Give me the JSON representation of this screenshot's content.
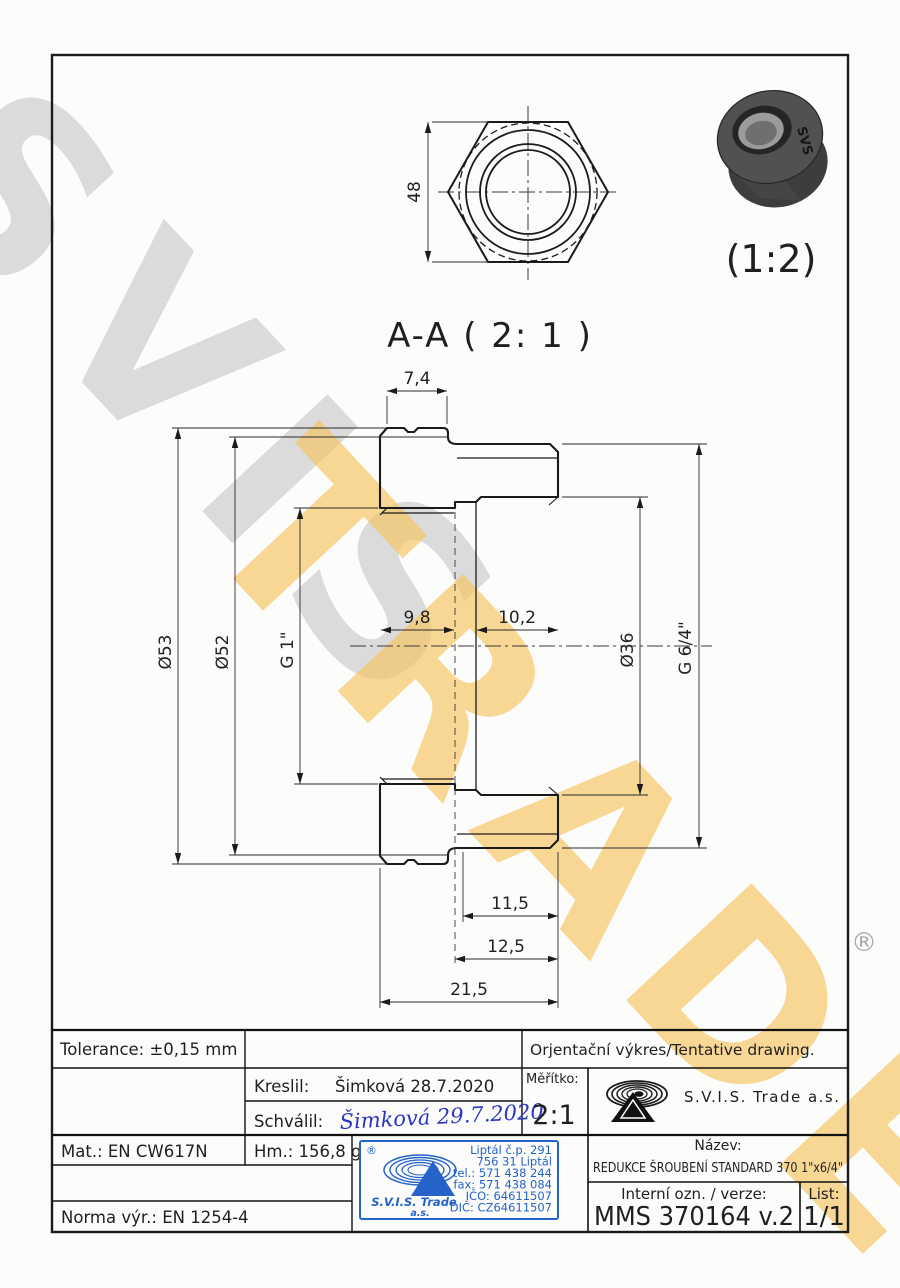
{
  "watermark": {
    "word1": "SVIS",
    "word2": "TRADE",
    "registered": "®"
  },
  "drawing": {
    "top_view_dim": "48",
    "photo_scale": "(1:2)",
    "photo_brand": "SVS",
    "section_title": "A-A ( 2: 1 )",
    "dims": {
      "flange_width": "7,4",
      "od": "Ø53",
      "af": "Ø52",
      "thread_left": "G 1\"",
      "depth_left": "9,8",
      "depth_right": "10,2",
      "bore": "Ø36",
      "thread_right": "G 6/4\"",
      "len1": "11,5",
      "len2": "12,5",
      "len_total": "21,5"
    }
  },
  "titleblock": {
    "tolerance": "Tolerance: ±0,15 mm",
    "tentative": "Orjentační výkres/Tentative drawing.",
    "kreslil_label": "Kreslil:",
    "kreslil_value": "Šimková 28.7.2020",
    "schvalil_label": "Schválil:",
    "schvalil_signature": "Šimková 29.7.2020",
    "meritko_label": "Měřítko:",
    "meritko_value": "2:1",
    "company": "S.V.I.S. Trade a.s.",
    "mat": "Mat.: EN CW617N",
    "hm": "Hm.: 156,8 g",
    "norma": "Norma výr.: EN 1254-4",
    "nazev_label": "Název:",
    "nazev_value": "REDUKCE ŠROUBENÍ STANDARD 370 1\"x6/4\"",
    "interni_label": "Interní ozn. / verze:",
    "interni_value": "MMS 370164 v.2",
    "list_label": "List:",
    "list_value": "1/1",
    "stamp": {
      "registered": "®",
      "brand": "S.V.I.S. Trade",
      "brand2": "a.s.",
      "lines": [
        "Liptál č.p. 291",
        "756 31 Liptál",
        "tel.: 571 438 244",
        "fax: 571 438 084",
        "IČO: 64611507",
        "DIČ: CZ64611507"
      ]
    }
  }
}
